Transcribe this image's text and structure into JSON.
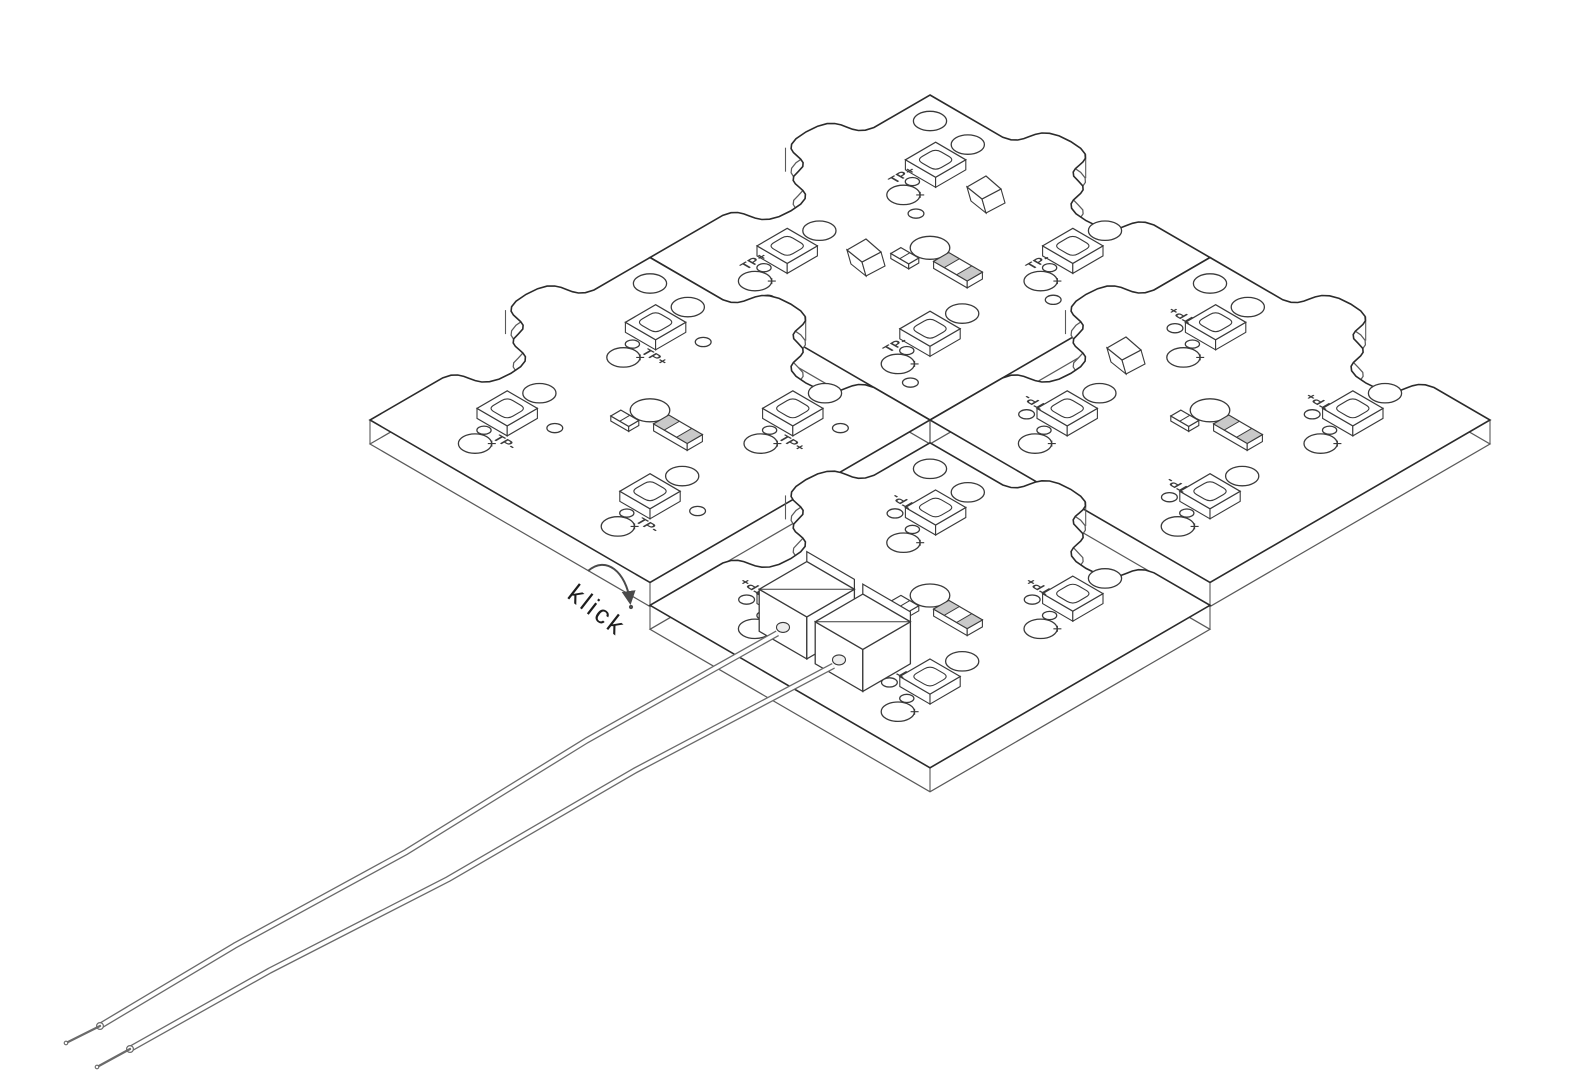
{
  "drawing": {
    "type": "isometric-technical-line-drawing",
    "subject": "puzzle-shaped LED PCB modules snapped together with wire leads"
  },
  "canvas": {
    "width": 1574,
    "height": 1082,
    "background": "#ffffff"
  },
  "colors": {
    "outline": "#2b2b2b",
    "edge_shadow": "#5a5a5a",
    "component": "#3a3a3a",
    "metal_cap": "#c9c9c9",
    "wire": "#6a6a6a",
    "annotation_ink": "#1d1d1d",
    "arrow": "#4a4a4a"
  },
  "annotation": {
    "klick": "klick"
  },
  "boards": [
    {
      "id": "north",
      "grid": [
        0,
        0
      ],
      "label_style": "up",
      "tp_labels": [
        "TP+",
        "TP-",
        "TP+",
        "TP-"
      ]
    },
    {
      "id": "east",
      "grid": [
        1,
        0
      ],
      "label_style": "flipped",
      "tp_labels": [
        "TP+",
        "TP+",
        "TP-",
        "TP-"
      ]
    },
    {
      "id": "west",
      "grid": [
        0,
        1
      ],
      "label_style": "flat",
      "tp_labels": [
        "TP+",
        "TP+",
        "TP-",
        "TP-"
      ]
    },
    {
      "id": "south",
      "grid": [
        1.07,
        1.07
      ],
      "label_style": "flipped",
      "tp_labels": [
        "TP-",
        "TP+",
        "TP+",
        "TP-"
      ],
      "detached": true,
      "has_connector": true
    }
  ],
  "board_template": {
    "leds": [
      {
        "pos": [
          0.24,
          0.22
        ]
      },
      {
        "pos": [
          0.75,
          0.24
        ]
      },
      {
        "pos": [
          0.24,
          0.75
        ]
      },
      {
        "pos": [
          0.75,
          0.75
        ]
      }
    ],
    "center_hole": {
      "pos": [
        0.47,
        0.47
      ],
      "r": 0.05
    },
    "corner_hole": {
      "pos": [
        0.08,
        0.08
      ],
      "r": 0.042
    },
    "resistor": {
      "pos": [
        0.6,
        0.5
      ]
    },
    "chip": {
      "pos": [
        0.465,
        0.555
      ]
    }
  },
  "connector": {
    "terminals": [
      [
        0.36,
        0.8
      ],
      [
        0.56,
        0.8
      ]
    ]
  },
  "wires": [
    {
      "end": [
        100,
        1026
      ],
      "tip": [
        66,
        1043
      ]
    },
    {
      "end": [
        130,
        1049
      ],
      "tip": [
        97,
        1067
      ]
    }
  ],
  "clips": [
    [
      988,
      205
    ],
    [
      868,
      268
    ],
    [
      1128,
      366
    ]
  ]
}
